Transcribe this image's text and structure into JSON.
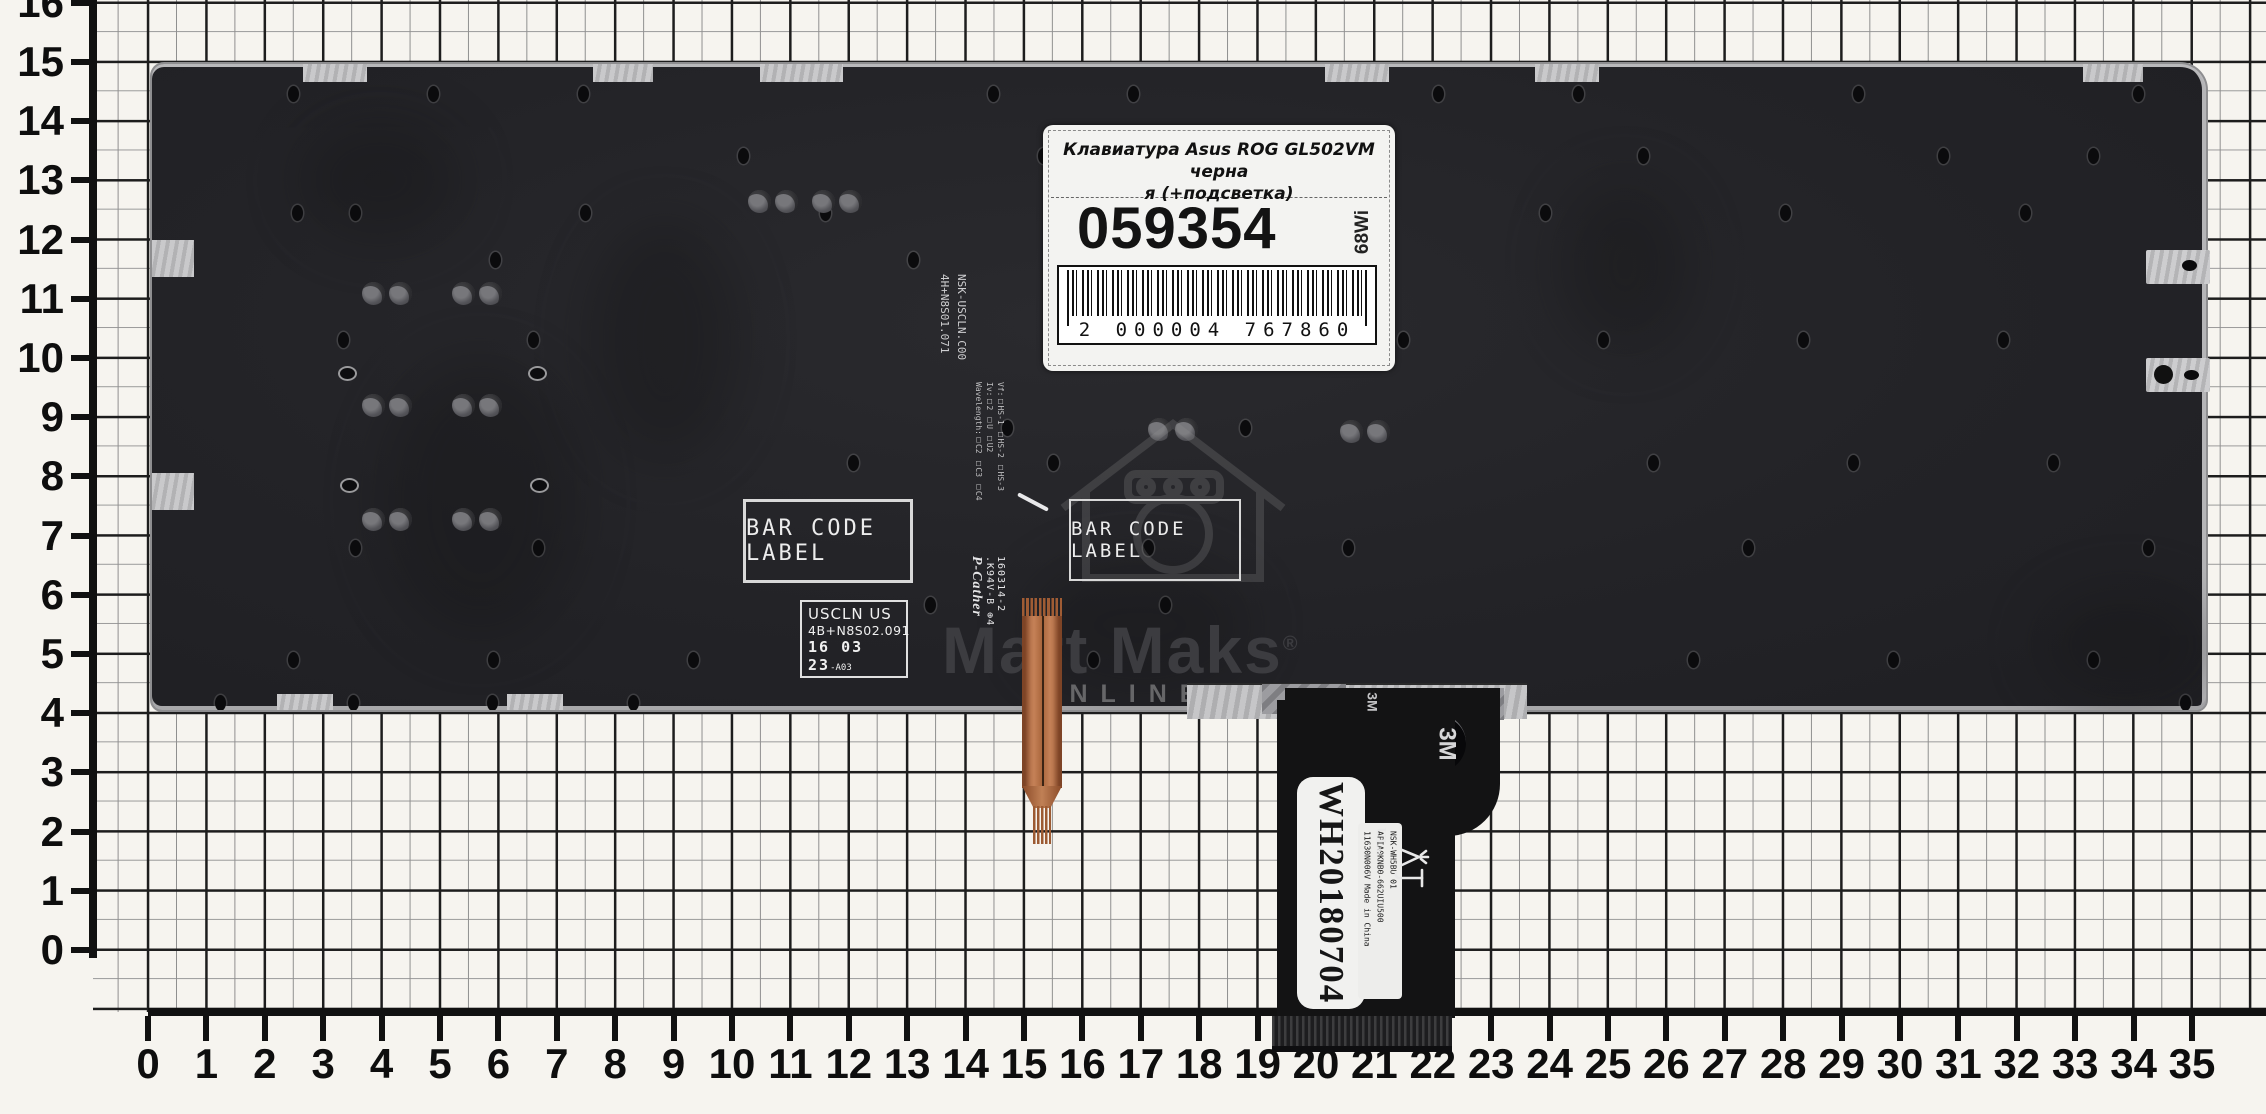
{
  "rulers": {
    "x_labels": [
      "0",
      "1",
      "2",
      "3",
      "4",
      "5",
      "6",
      "7",
      "8",
      "9",
      "10",
      "11",
      "12",
      "13",
      "14",
      "15",
      "16",
      "17",
      "18",
      "19",
      "20",
      "21",
      "22",
      "23",
      "24",
      "25",
      "26",
      "27",
      "28",
      "29",
      "30",
      "31",
      "32",
      "33",
      "34",
      "35"
    ],
    "y_labels": [
      "16",
      "15",
      "14",
      "13",
      "12",
      "11",
      "10",
      "9",
      "8",
      "7",
      "6",
      "5",
      "4",
      "3",
      "2",
      "1",
      "0"
    ]
  },
  "product_label": {
    "title_line1": "Клавиатура Asus ROG GL502VM черна",
    "title_line2": "я (+подсветка)",
    "sku": "059354",
    "side_code": "68Wi",
    "barcode_digits": "2 000004 767860"
  },
  "plate_markings": {
    "barcode_box1": "BAR CODE LABEL",
    "barcode_box2": "BAR CODE LABEL",
    "uscln_line1": "USCLN US",
    "uscln_line2": "4B+N8S02.091",
    "uscln_stamp": "16 03 23",
    "uscln_suffix": "-A03",
    "vert1_line1": "NSK-USCLN.C00",
    "vert1_line2": "4H+N8S01.071",
    "vert2_line1": "Vf:□HS-1 □HS-2 □HS-3",
    "vert2_line2": "Iv:□2 □U □U2",
    "vert2_line3": "Wavelength:□C2 □C3 □C4",
    "sig_script": "P-Cather",
    "sig_code": ".K94V-B ⊕4",
    "sig_date": "160314-2"
  },
  "ribbon": {
    "tape_brand": "3M",
    "tape_brand_small": "3M",
    "sticker_code": "WH20180704",
    "small_line1": "NSK-WH5BU 01",
    "small_line2": "APIA0KNB0-662UIU500",
    "small_line3": "11630N006V Made in China",
    "ul_mark": "UL",
    "ul_sub": "us",
    "lamp_char": "灯"
  },
  "watermark": {
    "brand": "Mart Maks",
    "reg": "®",
    "subtitle": "ONLINE STORE"
  },
  "colors": {
    "paper": "#f6f4ef",
    "grid_major": "#1d1d1d",
    "grid_minor": "#8f8f8f",
    "plate": "#232327",
    "silver_edge": "#b9b9bb",
    "copper": "#b9764e",
    "ribbon_black": "#131314",
    "label_bg": "#f3f3f1",
    "watermark_gray": "#3c3c40"
  }
}
